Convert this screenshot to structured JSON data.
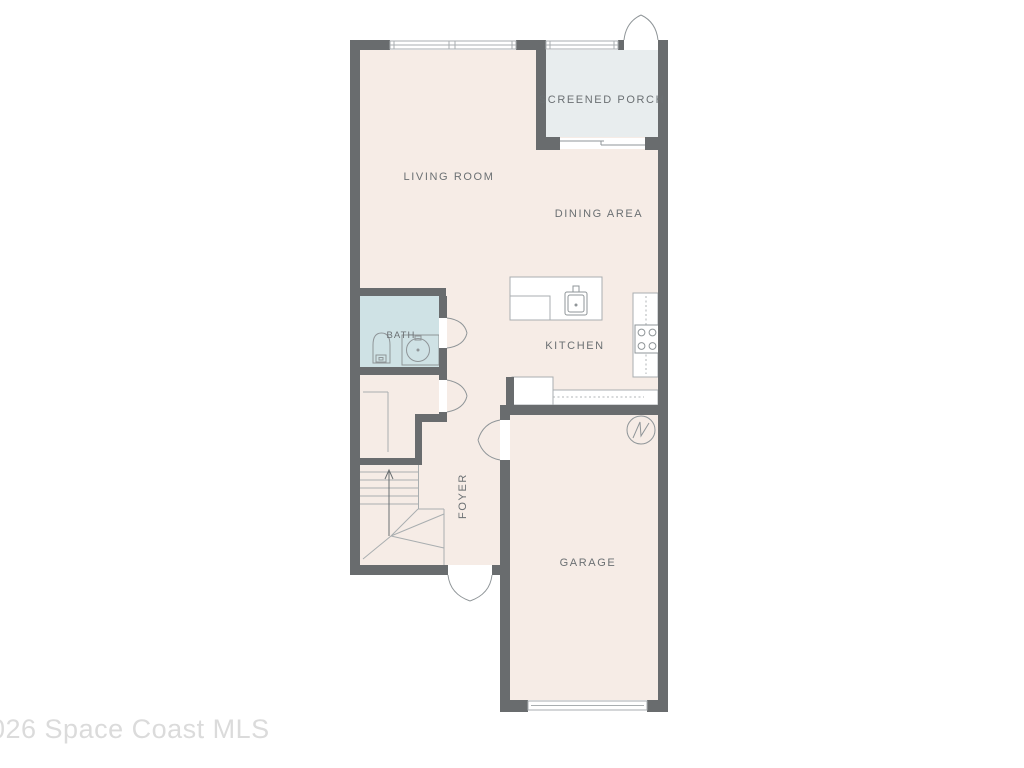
{
  "page": {
    "background": "#ffffff"
  },
  "watermark": {
    "text": "026 Space Coast MLS"
  },
  "floorplan": {
    "rooms": {
      "screened_porch": {
        "label": "SCREENED PORCH"
      },
      "living_room": {
        "label": "LIVING ROOM"
      },
      "dining_area": {
        "label": "DINING AREA"
      },
      "kitchen": {
        "label": "KITCHEN"
      },
      "bath": {
        "label": "BATH"
      },
      "foyer": {
        "label": "FOYER"
      },
      "garage": {
        "label": "GARAGE"
      }
    },
    "colors": {
      "wall": "#696c6e",
      "floor": "#f6ece6",
      "porch_floor": "#e8edee",
      "bath_floor": "#cfe2e5",
      "outline": "#a9aeb0",
      "fixture_line": "#8f9598",
      "label_text": "#6b7073",
      "watermark_text": "#dbdbdb"
    }
  }
}
